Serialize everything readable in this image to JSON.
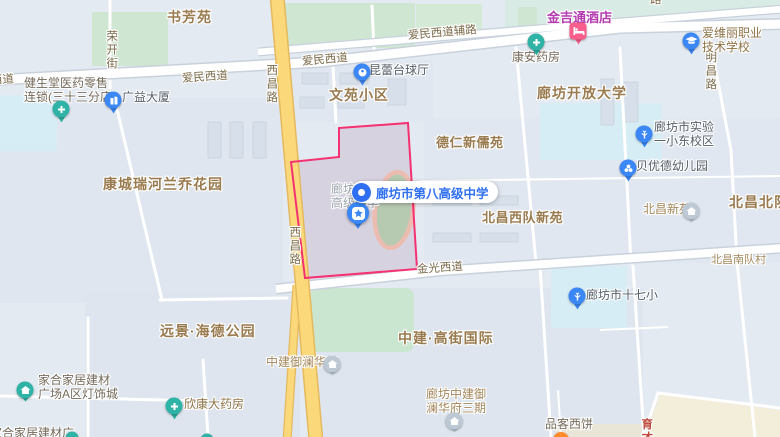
{
  "map": {
    "colors": {
      "highlight_border": "#f53171",
      "highlight_fill": "#d7d2e0",
      "callout_blue": "#2f6ff2",
      "pin_blue": "#3a87f5",
      "pin_teal": "#2eb3a6",
      "pin_pink": "#f95e8d",
      "pin_orange": "#ff8b2b",
      "pin_grayblue": "#bcc8d4",
      "road_yellow": "#fbd97b",
      "park_green": "#cfe7d2",
      "water_cyan": "#d7edf6"
    },
    "callout": {
      "label": "廊坊市第八高级中学"
    },
    "ghost_label": {
      "line1": "廊坊市第",
      "line2": "高级中学"
    },
    "labels": [
      {
        "name": "area-shufangyuan",
        "text": "书芳苑",
        "x": 167,
        "y": 9,
        "cls": "area lg"
      },
      {
        "name": "area-wenyuan-xiaoqu",
        "text": "文苑小区",
        "x": 329,
        "y": 87,
        "cls": "area lg"
      },
      {
        "name": "area-kangcheng-ruihe-lanqiao",
        "text": "康城瑞河兰乔花园",
        "x": 103,
        "y": 176,
        "cls": "area lg"
      },
      {
        "name": "area-deren-xinruyuan",
        "text": "德仁新儒苑",
        "x": 436,
        "y": 136,
        "cls": "area md"
      },
      {
        "name": "area-langfang-open-university",
        "text": "廊坊开放大学",
        "x": 537,
        "y": 85,
        "cls": "area lg"
      },
      {
        "name": "area-beichang-west-xinyuan",
        "text": "北昌西队新苑",
        "x": 482,
        "y": 211,
        "cls": "area md"
      },
      {
        "name": "area-beichang-north",
        "text": "北昌北队",
        "x": 729,
        "y": 194,
        "cls": "area lg"
      },
      {
        "name": "area-beichang-south-village",
        "text": "北昌南队村",
        "x": 711,
        "y": 254,
        "cls": "area sm"
      },
      {
        "name": "area-yuanjing-haide-park",
        "text": "远景·海德公园",
        "x": 160,
        "y": 323,
        "cls": "area lg"
      },
      {
        "name": "area-zhongjian-gaojie-intl",
        "text": "中建·高街国际",
        "x": 398,
        "y": 330,
        "cls": "area lg"
      },
      {
        "name": "poi-jinjitong-hotel-label",
        "text": "金吉通酒店",
        "x": 547,
        "y": 11,
        "cls": "poi hotel"
      },
      {
        "name": "road-rongkai-street",
        "text": "荣开街",
        "x": 104,
        "y": 30,
        "cls": "road vert"
      },
      {
        "name": "road-xichang-top",
        "text": "西昌路",
        "x": 264,
        "y": 64,
        "cls": "road vert"
      },
      {
        "name": "road-xichang-mid",
        "text": "西昌路",
        "x": 287,
        "y": 226,
        "cls": "road vert"
      },
      {
        "name": "road-mingchang",
        "text": "明昌路",
        "x": 703,
        "y": 51,
        "cls": "road vert"
      },
      {
        "name": "road-aimin-west-partial",
        "text": "西道",
        "x": -9,
        "y": 75,
        "cls": "road",
        "rotate": -4
      },
      {
        "name": "road-aimin-left",
        "text": "爱民西道",
        "x": 182,
        "y": 73,
        "cls": "road",
        "rotate": -4
      },
      {
        "name": "road-aimin-mid",
        "text": "爱民西道",
        "x": 302,
        "y": 56,
        "cls": "road",
        "rotate": -5
      },
      {
        "name": "road-aimin-fulu",
        "text": "爱民西道辅路",
        "x": 408,
        "y": 30,
        "cls": "road",
        "rotate": -5
      },
      {
        "name": "road-jinguang",
        "text": "金光西道",
        "x": 417,
        "y": 264,
        "cls": "road",
        "rotate": -4
      },
      {
        "name": "road-top-partial",
        "text": "路",
        "x": 650,
        "y": -6,
        "cls": "road"
      },
      {
        "name": "road-yucai",
        "text": "育才",
        "x": 639,
        "y": 418,
        "cls": "road vert red"
      },
      {
        "name": "poi-jianshengtang-pharmacy-label",
        "lines": [
          "健生堂医药零售",
          "连锁(三十三分店)"
        ],
        "x": 24,
        "y": 77,
        "cls": "poi gray2"
      },
      {
        "name": "poi-guangyi-building-label",
        "text": "广益大厦",
        "x": 122,
        "y": 91,
        "cls": "poi dark"
      },
      {
        "name": "poi-kunlei-billiards-label",
        "text": "昆蕾台球厅",
        "x": 369,
        "y": 64,
        "cls": "poi dark"
      },
      {
        "name": "poi-kangan-pharmacy-label",
        "text": "康安药房",
        "x": 512,
        "y": 51,
        "cls": "poi gray2"
      },
      {
        "name": "poi-aiweili-school-label",
        "lines": [
          "爱维丽职业",
          "技术学校"
        ],
        "x": 702,
        "y": 27,
        "cls": "poi brown2"
      },
      {
        "name": "poi-shiyan-school-label",
        "lines": [
          "廊坊市实验",
          "一小东校区"
        ],
        "x": 654,
        "y": 121,
        "cls": "poi dark"
      },
      {
        "name": "poi-beiyoude-kindergarten-label",
        "text": "贝优德幼儿园",
        "x": 636,
        "y": 160,
        "cls": "poi dark"
      },
      {
        "name": "poi-beichang-xinyuan-label",
        "text": "北昌新苑",
        "x": 643,
        "y": 203,
        "cls": "poi tan"
      },
      {
        "name": "poi-shiqixiao-school-label",
        "text": "廊坊市十七小",
        "x": 586,
        "y": 289,
        "cls": "poi dark"
      },
      {
        "name": "poi-zhongjian-yulan-label",
        "text": "中建御澜华府",
        "x": 266,
        "y": 356,
        "cls": "poi tan"
      },
      {
        "name": "poi-yulan-phase3-label",
        "lines": [
          "廊坊中建御",
          "澜华府三期"
        ],
        "x": 426,
        "y": 388,
        "cls": "poi tan"
      },
      {
        "name": "poi-xinkang-pharmacy-label",
        "text": "欣康大药房",
        "x": 184,
        "y": 398,
        "cls": "poi brown2"
      },
      {
        "name": "poi-jiahe-homestore-label",
        "lines": [
          "家合家居建材",
          "广场A区灯饰城"
        ],
        "x": 38,
        "y": 374,
        "cls": "poi gray2"
      },
      {
        "name": "poi-pinke-bakery-label",
        "text": "品客西饼",
        "x": 545,
        "y": 418,
        "cls": "poi gray2"
      },
      {
        "name": "poi-bottom-edge-partial",
        "text": "家合家居建材广",
        "x": -10,
        "y": 427,
        "cls": "poi gray2"
      }
    ],
    "pins": [
      {
        "name": "pin-jianshengtang-pharmacy",
        "type": "drop",
        "glyph": "cross",
        "color": "teal",
        "x": 61,
        "y": 109
      },
      {
        "name": "pin-guangyi-building",
        "type": "drop",
        "glyph": "building",
        "color": "blue",
        "x": 113,
        "y": 100
      },
      {
        "name": "pin-kunlei-billiards",
        "type": "drop",
        "glyph": "billiard",
        "color": "blue",
        "x": 362,
        "y": 72
      },
      {
        "name": "pin-kangan-pharmacy",
        "type": "drop",
        "glyph": "cross",
        "color": "teal",
        "x": 536,
        "y": 42
      },
      {
        "name": "pin-jinjitong-hotel",
        "type": "square",
        "glyph": "bed",
        "color": "pink",
        "x": 578,
        "y": 31
      },
      {
        "name": "pin-aiweili-school",
        "type": "drop",
        "glyph": "cap",
        "color": "blue",
        "x": 691,
        "y": 41
      },
      {
        "name": "pin-shiyan-school",
        "type": "drop",
        "glyph": "tree",
        "color": "blue",
        "x": 644,
        "y": 134
      },
      {
        "name": "pin-beiyoude-kindergarten",
        "type": "drop",
        "glyph": "flower",
        "color": "blue",
        "x": 628,
        "y": 168
      },
      {
        "name": "pin-beichang-xinyuan",
        "type": "circle",
        "glyph": "house",
        "color": "grayblue",
        "x": 691,
        "y": 211
      },
      {
        "name": "pin-shiqixiao-school",
        "type": "drop",
        "glyph": "tree",
        "color": "blue",
        "x": 577,
        "y": 296
      },
      {
        "name": "pin-zhongjian-yulan",
        "type": "circle",
        "glyph": "house",
        "color": "grayblue",
        "x": 332,
        "y": 364
      },
      {
        "name": "pin-yulan-phase3",
        "type": "circle",
        "glyph": "house",
        "color": "grayblue",
        "x": 454,
        "y": 421
      },
      {
        "name": "pin-xinkang-pharmacy",
        "type": "drop",
        "glyph": "cross",
        "color": "teal",
        "x": 174,
        "y": 406
      },
      {
        "name": "pin-jiahe-homestore",
        "type": "circle",
        "glyph": "house",
        "color": "teal",
        "x": 25,
        "y": 390
      },
      {
        "name": "pin-pinke-bakery",
        "type": "dot",
        "color": "orange",
        "x": 561,
        "y": 440,
        "size": 16
      },
      {
        "name": "pin-edge-dot-left",
        "type": "dot",
        "color": "teal",
        "x": 72,
        "y": 438,
        "size": 13
      },
      {
        "name": "pin-edge-dot-mid",
        "type": "dot",
        "color": "teal",
        "x": 207,
        "y": 440,
        "size": 13
      }
    ]
  }
}
